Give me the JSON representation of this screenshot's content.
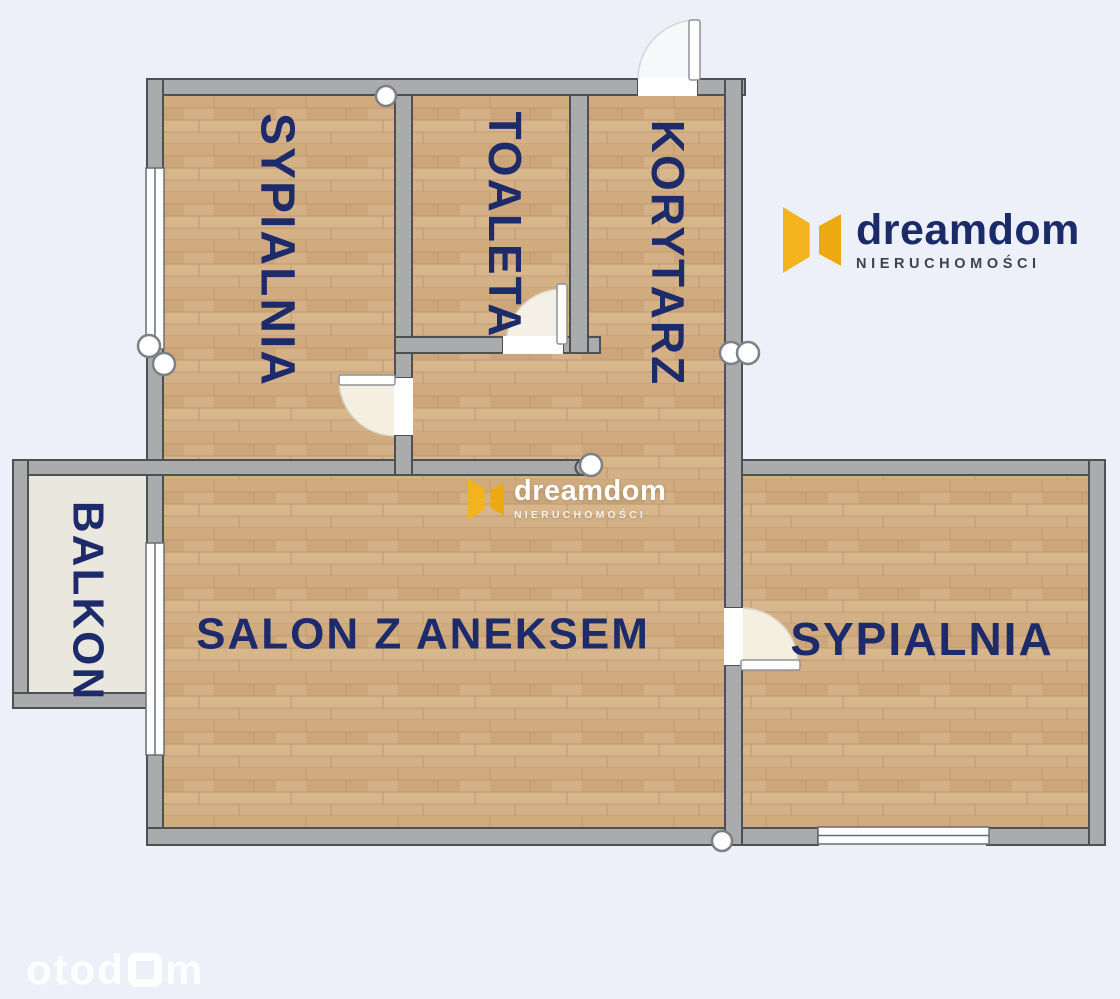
{
  "plan": {
    "rooms": {
      "bedroom_top": {
        "label": "SYPIALNIA"
      },
      "toilet": {
        "label": "TOALETA"
      },
      "hallway": {
        "label": "KORYTARZ"
      },
      "balcony": {
        "label": "BALKON"
      },
      "living": {
        "label": "SALON Z ANEKSEM"
      },
      "bedroom_right": {
        "label": "SYPIALNIA"
      }
    }
  },
  "brand": {
    "name": "dreamdom",
    "tagline": "NIERUCHOMOŚCI"
  },
  "watermarks": {
    "center": {
      "name": "dreamdom",
      "tagline": "NIERUCHOMOŚCI"
    },
    "portal": {
      "prefix": "otod",
      "suffix": "m"
    }
  },
  "colors": {
    "background": "#edf0f8",
    "wall_fill": "#a9abad",
    "wall_outline": "#4e5154",
    "floor_wood": "#d3af84",
    "balcony_floor": "#eae7df",
    "label_navy": "#1d2b6b",
    "logo_navy": "#1b2a68",
    "logo_yellow": "#f3b31f"
  }
}
